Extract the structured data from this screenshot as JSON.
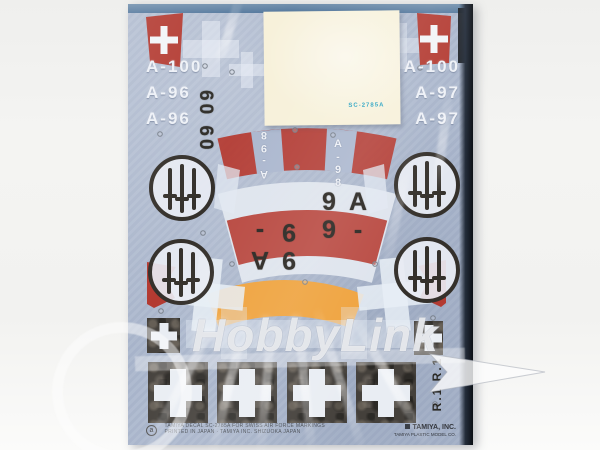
{
  "sheet": {
    "aircraft_codes_left": [
      "A-100",
      "A-96",
      "A-96"
    ],
    "aircraft_codes_right": [
      "A-100",
      "A-97",
      "A-97"
    ],
    "stencil_code_rotated": "60 60",
    "upper_band_codes": [
      "A-98",
      "A-98"
    ],
    "lower_band_codes": [
      "A-99",
      "A-99"
    ],
    "rudder_code": "R.1 R.1",
    "paper_slip_code": "SC-2785A",
    "footer": {
      "mark": "a",
      "fine_print_line1": "TAMIYA DECAL SC-2785A FOR SWISS AIR FORCE MARKINGS",
      "fine_print_line2": "PRINTED IN JAPAN · TAMIYA INC. SHIZUOKA JAPAN",
      "brand": "TAMIYA, INC.",
      "brand_sub": "TAMIYA PLASTIC MODEL CO."
    }
  },
  "watermark": {
    "brand": "HobbyLink"
  },
  "colors": {
    "sheet_blue": "#aab6cc",
    "swiss_red": "#b33a31",
    "band_red": "#b5382f",
    "band_orange": "#efa23c",
    "decal_white": "#e9edf3",
    "decal_black": "#44403b",
    "slip_cream": "#f7f1da",
    "slip_code_teal": "#2aa3c2"
  }
}
